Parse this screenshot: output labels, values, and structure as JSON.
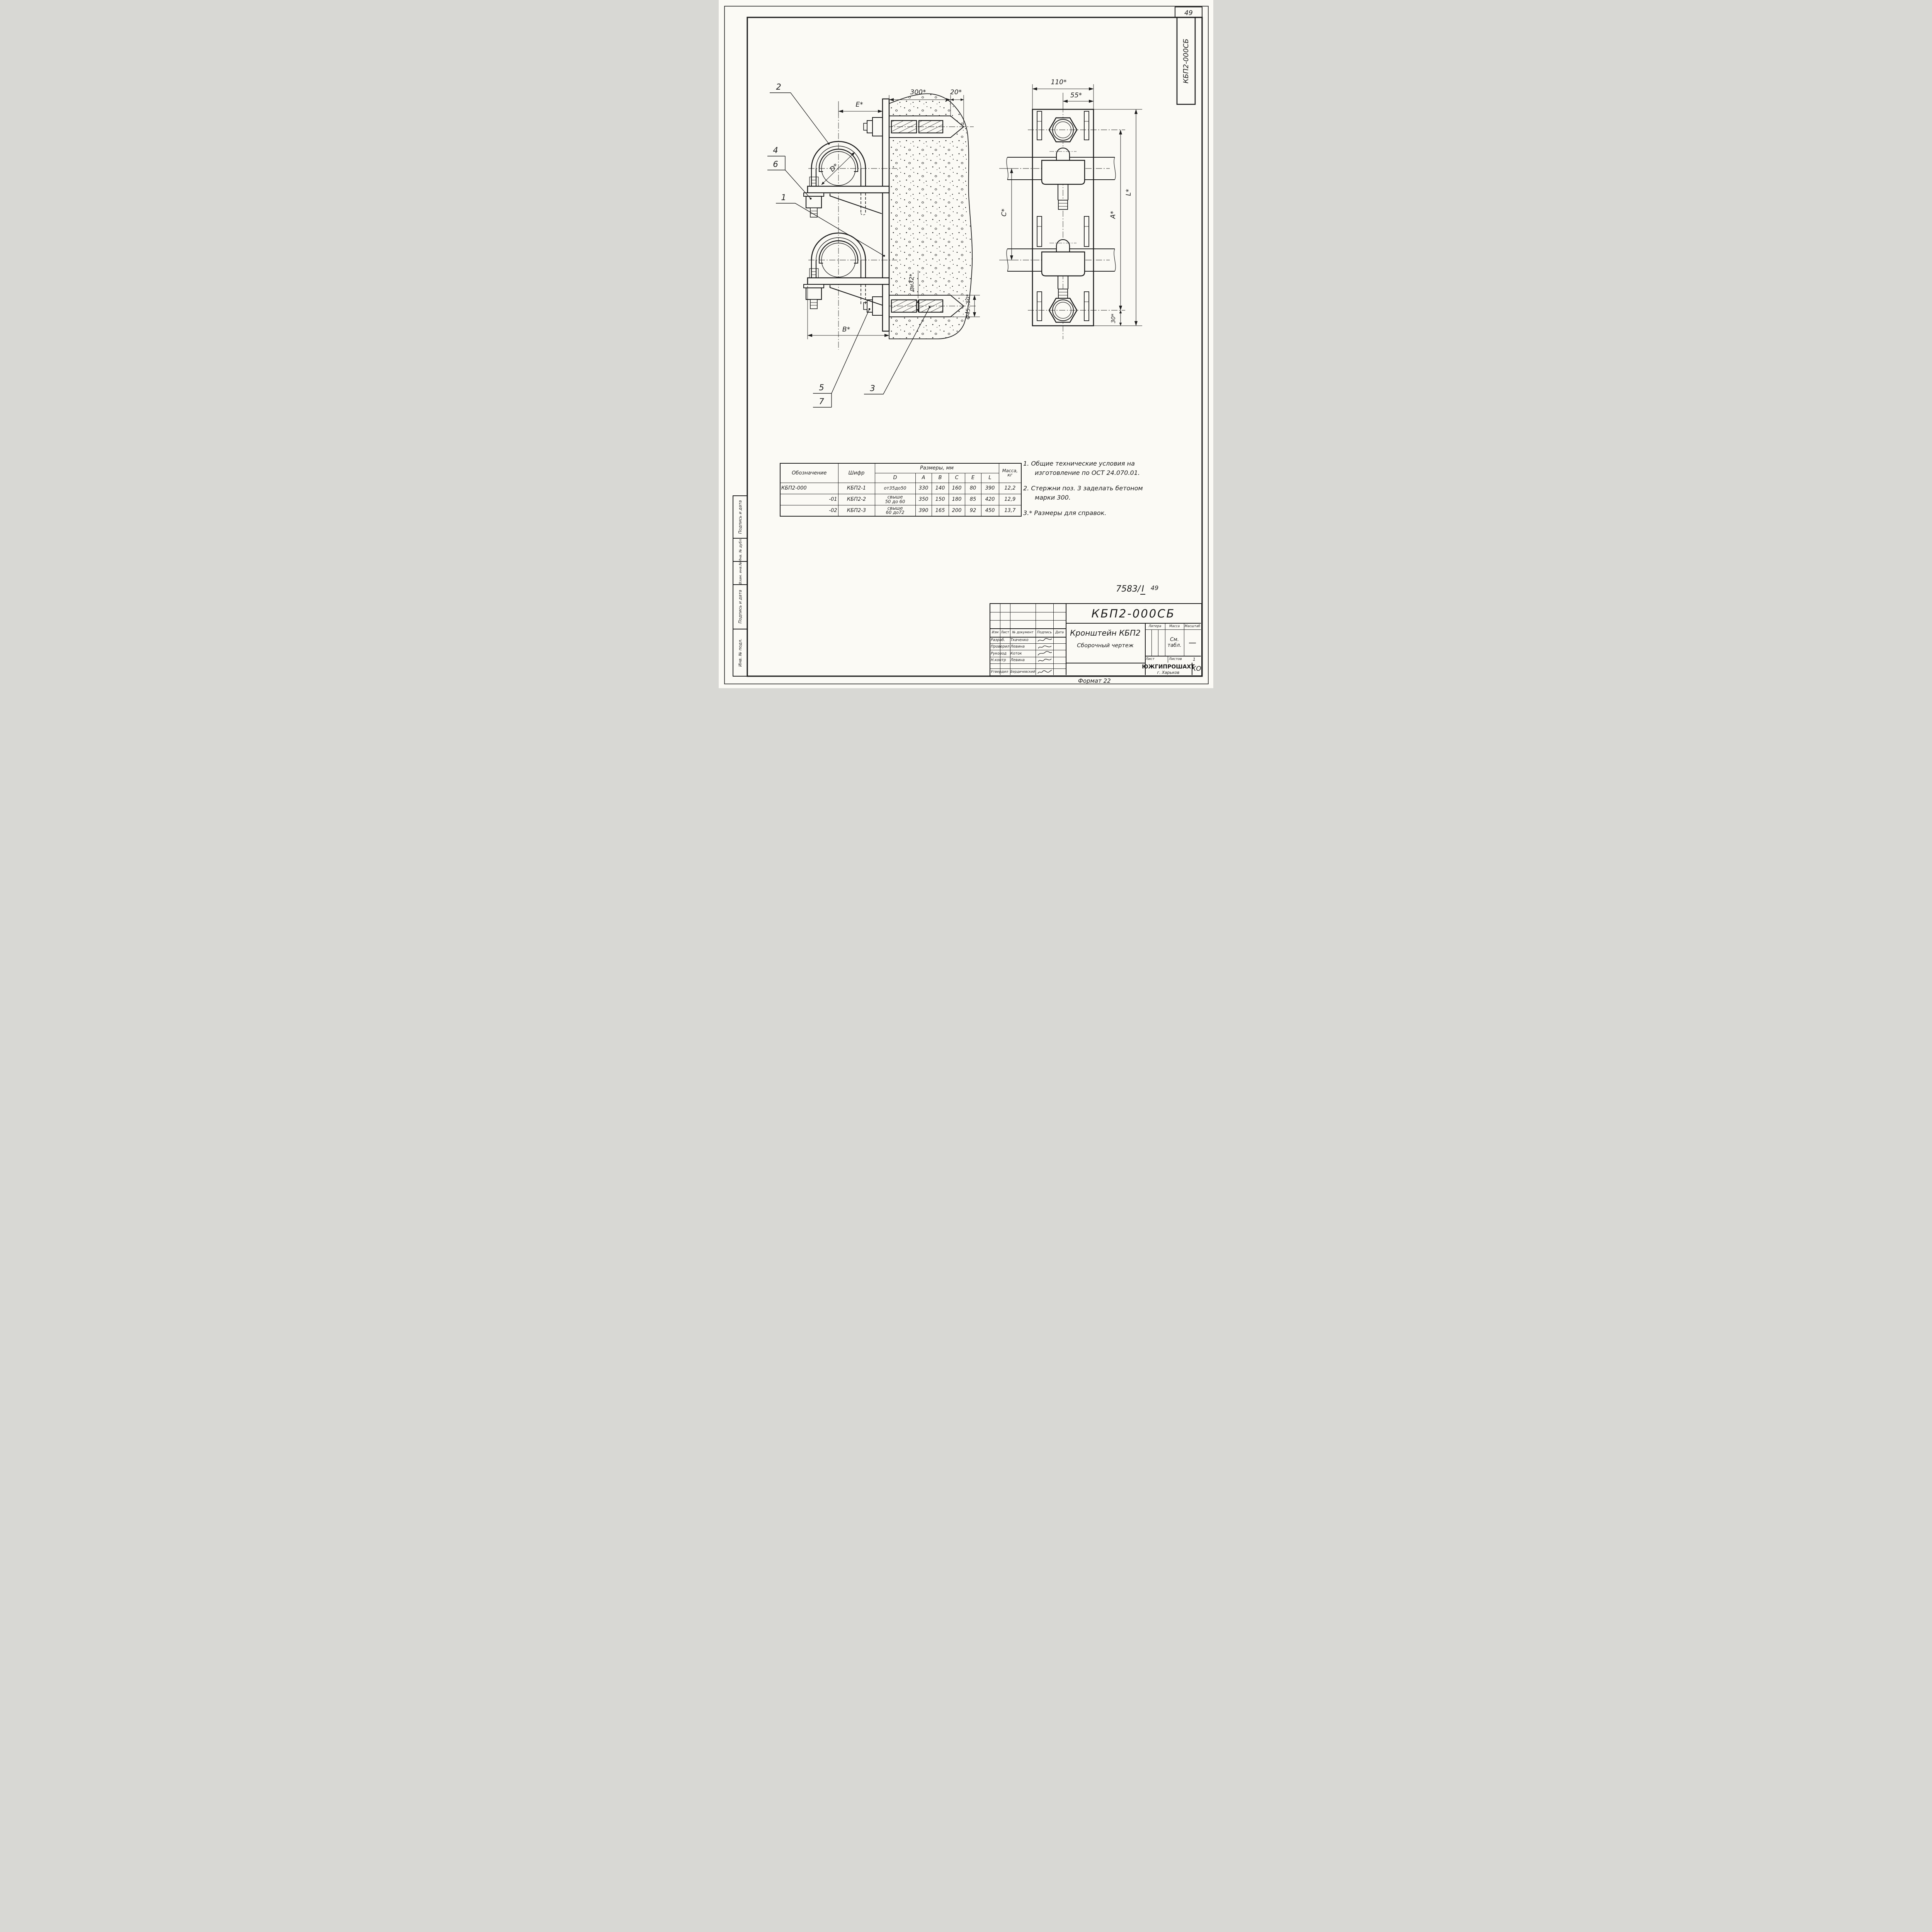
{
  "page": {
    "sheet_number": "49",
    "corner_stamp": "КБП2-000СБ",
    "doc_ref": "7583/",
    "doc_ref_roman": "I",
    "doc_ref_page": "49",
    "format_label": "Формат 22"
  },
  "dims": {
    "e": "E*",
    "n300": "300*",
    "n20": "20*",
    "b": "B*",
    "d": "D*",
    "rod": "дн32*",
    "hole": "Ф45...50*",
    "w110": "110*",
    "w55": "55*",
    "c": "C*",
    "a": "A*",
    "l": "L*",
    "n30": "30*"
  },
  "callouts": {
    "c1": "1",
    "c2": "2",
    "c3": "3",
    "c4": "4",
    "c5": "5",
    "c6": "6",
    "c7": "7"
  },
  "table": {
    "header": {
      "designation": "Обозначение",
      "code": "Шифр",
      "sizes": "Размеры, мм",
      "cols": [
        "D",
        "A",
        "B",
        "C",
        "E",
        "L"
      ],
      "mass1": "Масса,",
      "mass2": "кг"
    },
    "rows": [
      {
        "designation": "КБП2-000",
        "code": "КБП2-1",
        "d1": "от35до50",
        "d2": "",
        "a": "330",
        "b": "140",
        "c": "160",
        "e": "80",
        "l": "390",
        "m": "12,2"
      },
      {
        "designation": "-01",
        "code": "КБП2-2",
        "d1": "свыше",
        "d2": "50 до 60",
        "a": "350",
        "b": "150",
        "c": "180",
        "e": "85",
        "l": "420",
        "m": "12,9"
      },
      {
        "designation": "-02",
        "code": "КБП2-3",
        "d1": "свыше",
        "d2": "60 до72",
        "a": "390",
        "b": "165",
        "c": "200",
        "e": "92",
        "l": "450",
        "m": "13,7"
      }
    ]
  },
  "notes": [
    {
      "l1": "1. Общие технические условия на",
      "l2": "изготовление по ОСТ 24.070.01."
    },
    {
      "l1": "2. Стержни поз. 3 заделать бетоном",
      "l2": "марки 300."
    },
    {
      "l1": "3.* Размеры для справок.",
      "l2": ""
    }
  ],
  "title_block": {
    "doc_number": "КБП2-000СБ",
    "product": "Кронштейн КБП2",
    "doc_type": "Сборочный чертеж",
    "cols": [
      "Изм",
      "Лист",
      "№ документ",
      "Подпись",
      "Дата"
    ],
    "rows": [
      {
        "role": "Разраб.",
        "name": "Ткаченко"
      },
      {
        "role": "Проверил",
        "name": "Левина"
      },
      {
        "role": "Руковод",
        "name": "Коток"
      },
      {
        "role": "Н.контр",
        "name": "Левина"
      },
      {
        "role": "Утвердил",
        "name": "Бердичевский"
      }
    ],
    "litera": "Литера",
    "mass": "Масса",
    "scale": "Масштаб",
    "mass_value1": "См.",
    "mass_value2": "табл.",
    "scale_value": "—",
    "sheet": "Лист",
    "sheets": "Листов",
    "sheets_value": "1",
    "org": "ЮЖГИПРОШАХТ",
    "city": "г. Харьков",
    "dept": "КО"
  },
  "margin_labels": [
    "Подпись и дата",
    "Инв. № дубл.",
    "Взам. инв.№",
    "Подпись и дата",
    "Инв. № подл."
  ]
}
